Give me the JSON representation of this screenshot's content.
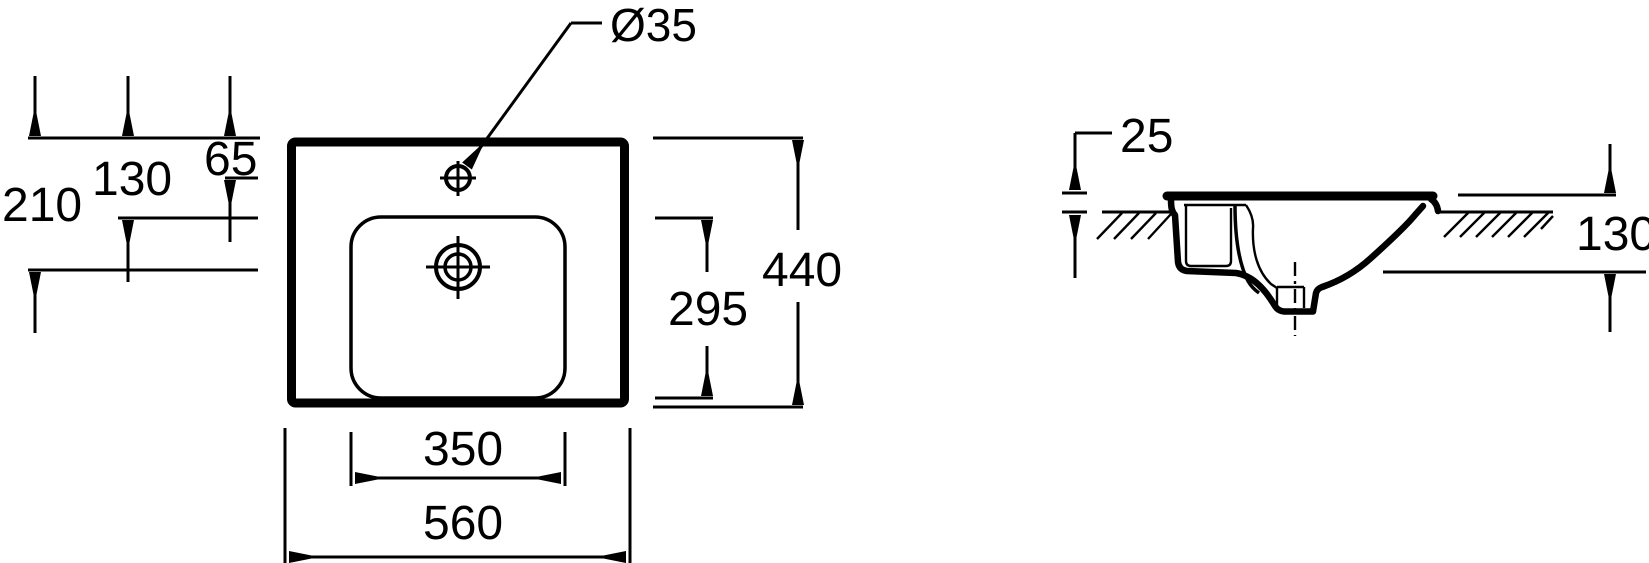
{
  "drawing": {
    "title": "Washbasin technical dimension drawing",
    "views": {
      "left": "top plan view of basin",
      "right": "side section view installed in counter"
    }
  },
  "labels": {
    "hole_diameter": "Ø35",
    "drain_offset_from_top": "210",
    "basin_top_offset": "130",
    "hole_offset_from_top": "65",
    "basin_inner_depth": "295",
    "overall_depth": "440",
    "basin_inner_width": "350",
    "overall_width": "560",
    "rim_height_above_counter": "25",
    "mounting_depth_below_rim": "130"
  }
}
